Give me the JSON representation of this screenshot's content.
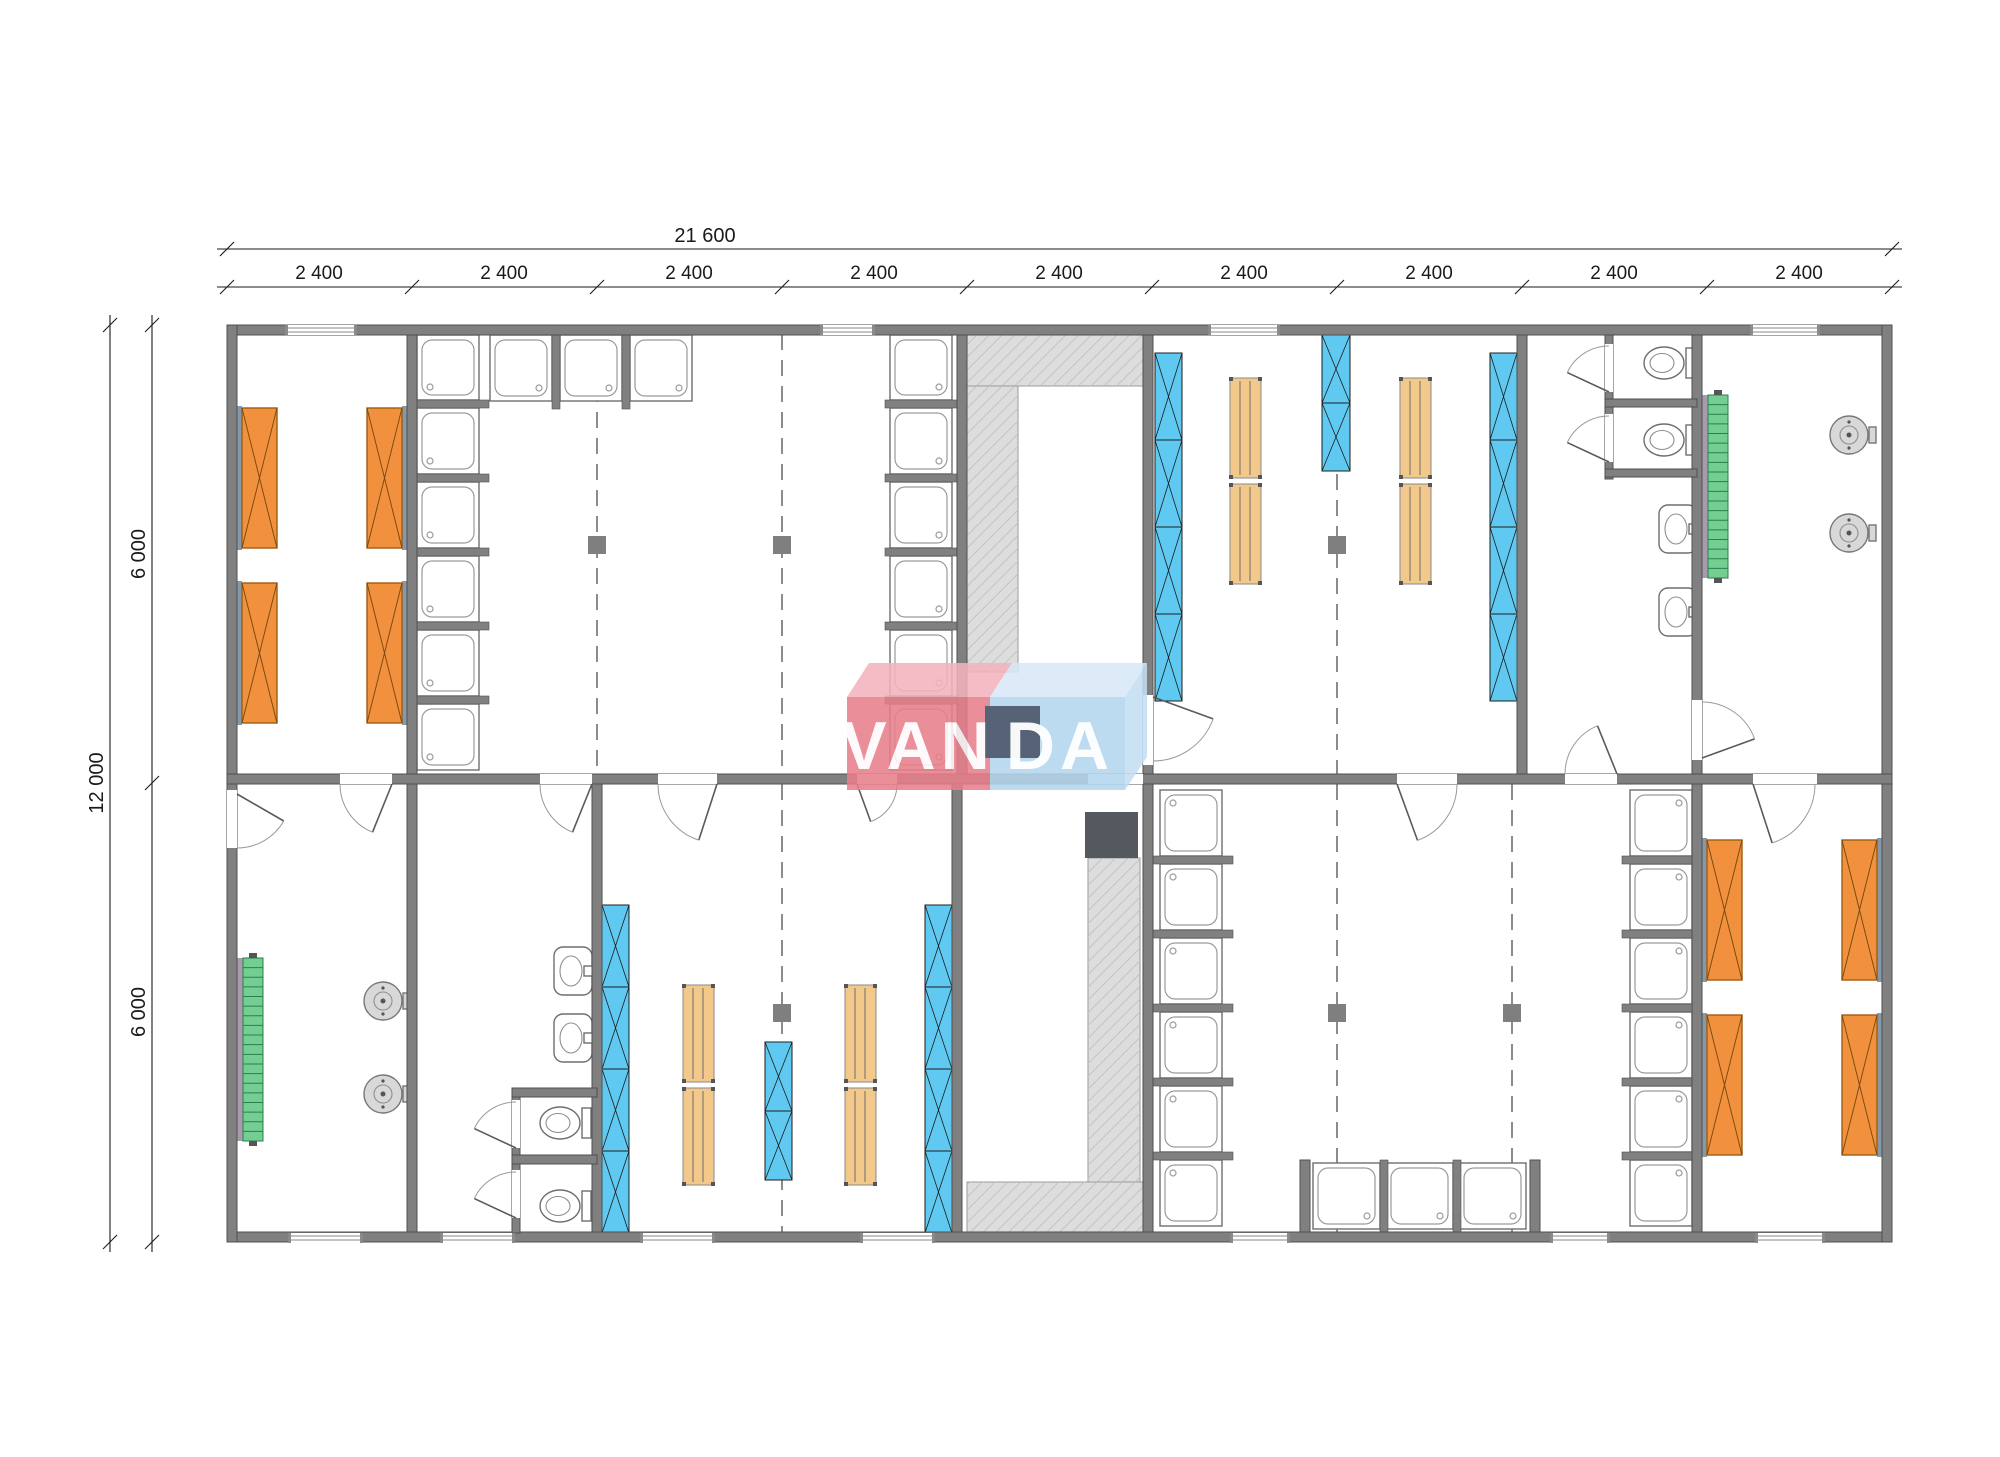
{
  "dimensions": {
    "top_total": "21 600",
    "top_segments": [
      "2 400",
      "2 400",
      "2 400",
      "2 400",
      "2 400",
      "2 400",
      "2 400",
      "2 400",
      "2 400"
    ],
    "left_total": "12 000",
    "left_segments": [
      "6 000",
      "6 000"
    ]
  },
  "logo": {
    "text": "VANDA",
    "part_red": "VAN",
    "part_blue": "DA"
  },
  "fixtures": {
    "shower_stalls": 30,
    "bunk_beds": 8,
    "lockers": 20,
    "bench_segments": 8,
    "toilets": 4,
    "sinks": 4,
    "washing_machines": 4,
    "staircases": 2,
    "service_columns": 6
  },
  "colors": {
    "wall": "#808080",
    "wall_stroke": "#4f4f4f",
    "bed": "#F2913D",
    "bed_back": "#8699A9",
    "locker": "#5FC9F1",
    "bench": "#F3C98B",
    "stairs": "#73CE92",
    "stairs_line": "#2E7D4F",
    "stairs_rail": "#A89BAB",
    "hatch_bg": "#DDDDDD",
    "hatch_line": "#C3C3C3",
    "fixture_line": "#6E6E6E",
    "washer": "#D8D8D8",
    "dark_box": "#54595F",
    "navy_box": "#3D4C62",
    "module_line": "#8C8C8C",
    "column": "#7F7F7F",
    "dim": "#1A1A1A",
    "door": "#5A5A5A",
    "logo_red": "#E87E8B",
    "logo_red_top": "#F3B3BC",
    "logo_blue": "#B4D6EE",
    "logo_blue_top": "#D7E9F6",
    "logo_blue_side": "#C3DEF2",
    "logo_text": "#FFFFFF",
    "floor": "#FFFFFF"
  }
}
